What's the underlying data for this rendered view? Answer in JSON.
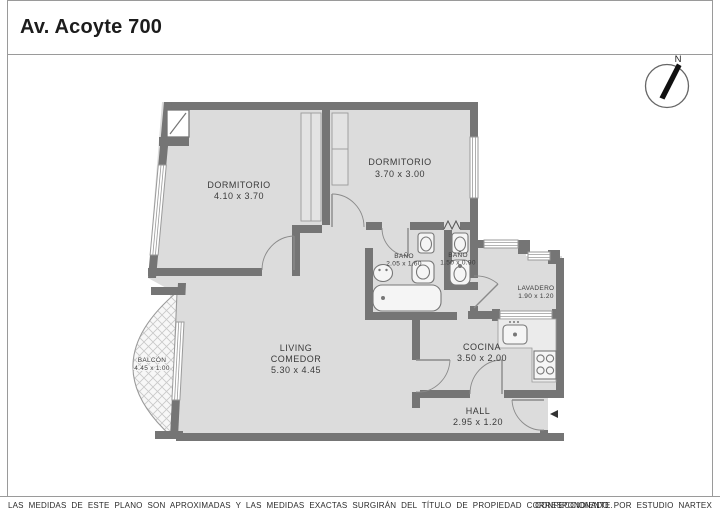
{
  "title": "Av. Acoyte 700",
  "compass": {
    "north_label": "N"
  },
  "rooms": {
    "dormitorio_1": {
      "name": "DORMITORIO",
      "dimensions": "4.10 x 3.70"
    },
    "dormitorio_2": {
      "name": "DORMITORIO",
      "dimensions": "3.70 x 3.00"
    },
    "bano_1": {
      "name": "BAÑO",
      "dimensions": "2.05 x 1.60"
    },
    "bano_2": {
      "name": "BAÑO",
      "dimensions": "1.50 x 0.90"
    },
    "lavadero": {
      "name": "LAVADERO",
      "dimensions": "1.90 x 1.20"
    },
    "living_comedor": {
      "name_line1": "LIVING",
      "name_line2": "COMEDOR",
      "dimensions": "5.30 x 4.45"
    },
    "cocina": {
      "name": "COCINA",
      "dimensions": "3.50 x 2.00"
    },
    "hall": {
      "name": "HALL",
      "dimensions": "2.95 x 1.20"
    },
    "balcon": {
      "name": "BALCÓN",
      "dimensions": "4.45 x 1.00"
    }
  },
  "footer": {
    "disclaimer": "LAS MEDIDAS  DE ESTE PLANO SON APROXIMADAS Y LAS MEDIDAS EXACTAS SURGIRÁN DEL TÍTULO DE PROPIEDAD CORRESPONDIENTE.",
    "credit": "CONFECCIONADO POR ESTUDIO NARTEX"
  },
  "colors": {
    "wall": "#757575",
    "floor": "#dcdcdc",
    "window_line": "#9a9a9a",
    "door_line": "#8a8a8a",
    "text": "#3a3a3a"
  }
}
